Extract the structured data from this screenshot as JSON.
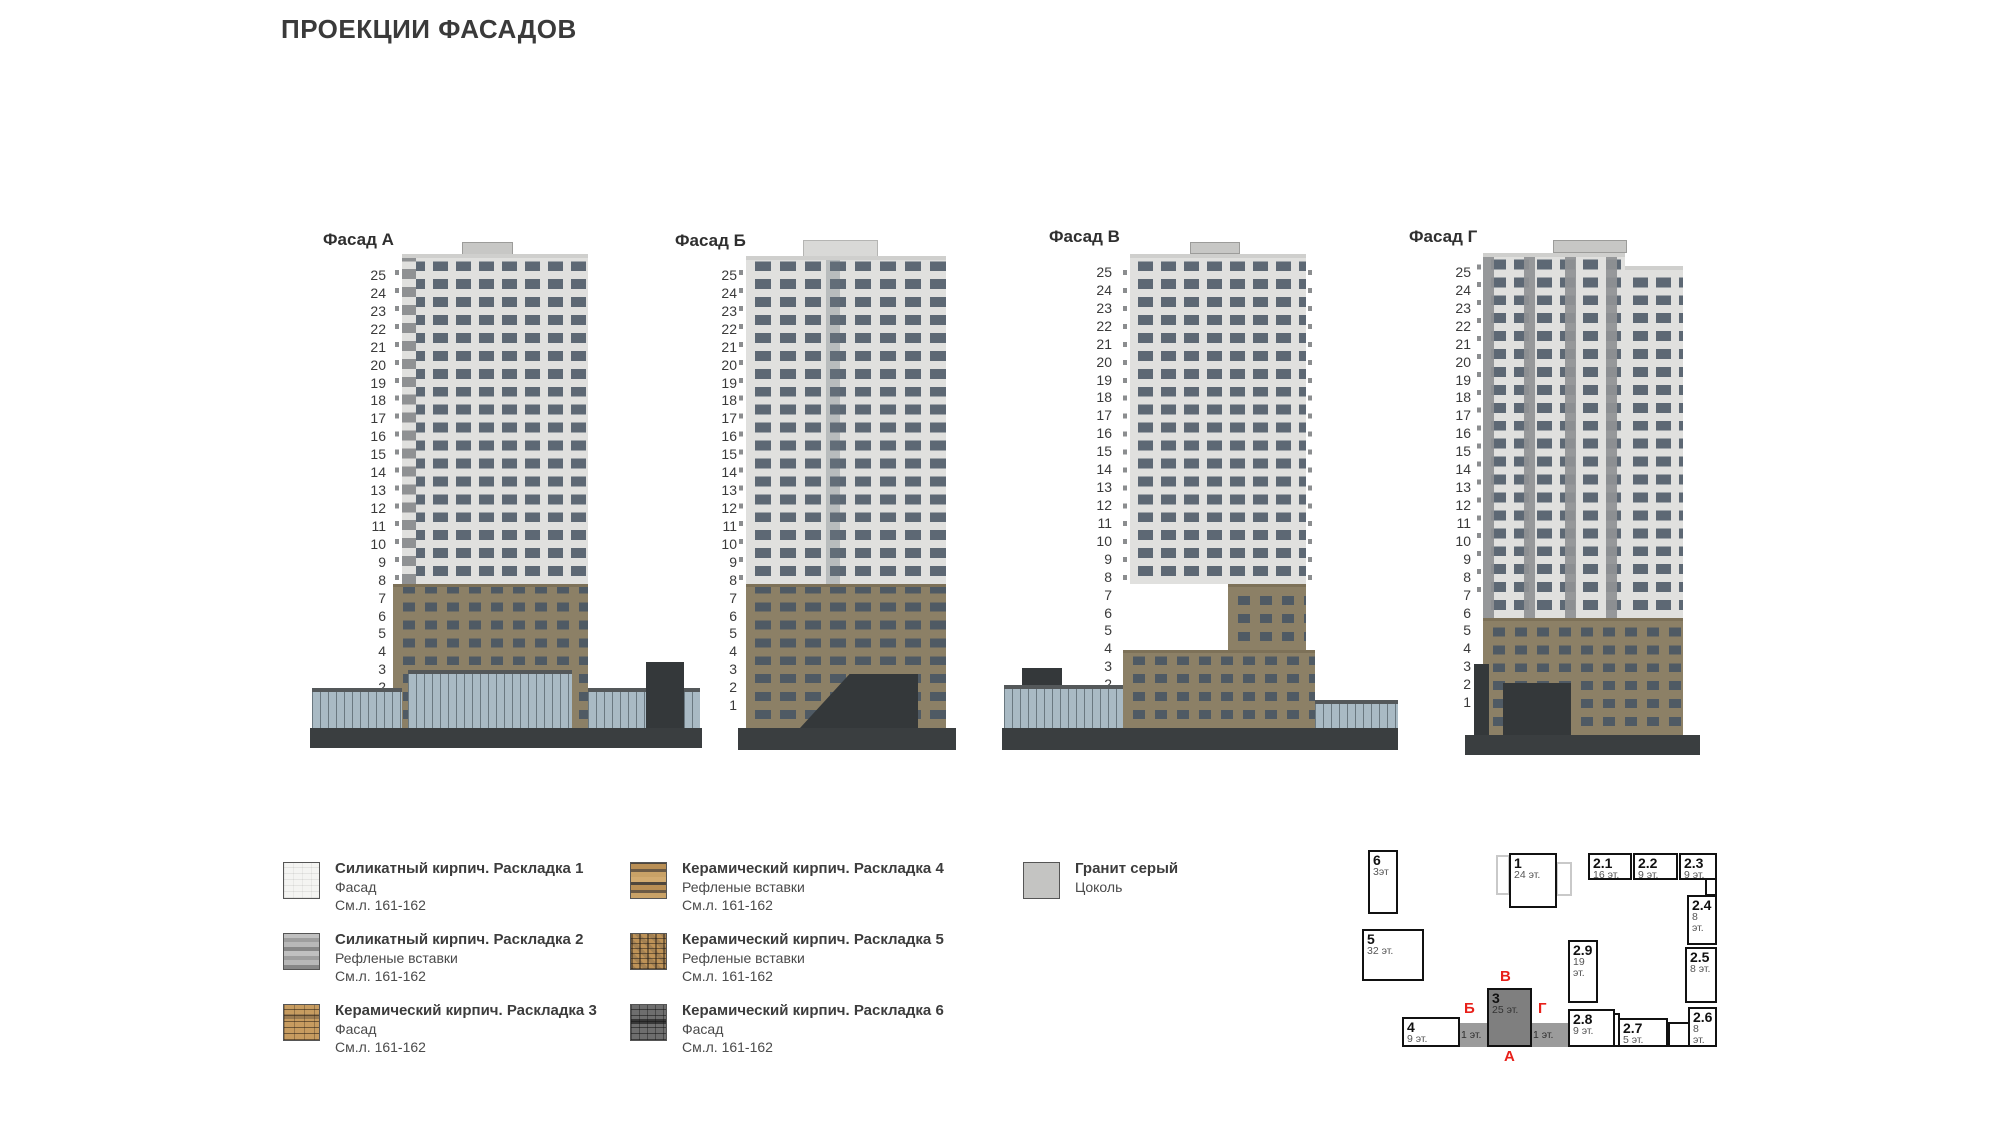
{
  "title": "ПРОЕКЦИИ ФАСАДОВ",
  "floor_numbers": [
    25,
    24,
    23,
    22,
    21,
    20,
    19,
    18,
    17,
    16,
    15,
    14,
    13,
    12,
    11,
    10,
    9,
    8,
    7,
    6,
    5,
    4,
    3,
    2,
    1
  ],
  "facades": [
    {
      "id": "a",
      "label": "Фасад А"
    },
    {
      "id": "b",
      "label": "Фасад Б"
    },
    {
      "id": "v",
      "label": "Фасад В"
    },
    {
      "id": "g",
      "label": "Фасад Г"
    }
  ],
  "legend": {
    "items": [
      {
        "title": "Силикатный кирпич. Раскладка 1",
        "line2": "Фасад",
        "line3": "См.л. 161-162",
        "swatch": "s1"
      },
      {
        "title": "Силикатный кирпич. Раскладка 2",
        "line2": "Рефленые вставки",
        "line3": "См.л. 161-162",
        "swatch": "s2"
      },
      {
        "title": "Керамический кирпич. Раскладка 3",
        "line2": "Фасад",
        "line3": "См.л. 161-162",
        "swatch": "s3"
      },
      {
        "title": "Керамический кирпич. Раскладка 4",
        "line2": "Рефленые вставки",
        "line3": "См.л. 161-162",
        "swatch": "s4"
      },
      {
        "title": "Керамический кирпич. Раскладка 5",
        "line2": "Рефленые вставки",
        "line3": "См.л. 161-162",
        "swatch": "s5"
      },
      {
        "title": "Керамический кирпич. Раскладка 6",
        "line2": "Фасад",
        "line3": "См.л. 161-162",
        "swatch": "s6"
      },
      {
        "title": "Гранит серый",
        "line2": "Цоколь",
        "line3": "",
        "swatch": "s7"
      }
    ]
  },
  "site_plan": {
    "blocks": [
      {
        "id": "6",
        "num": "6",
        "floors": "3эт"
      },
      {
        "id": "5",
        "num": "5",
        "floors": "32 эт."
      },
      {
        "id": "1",
        "num": "1",
        "floors": "24 эт."
      },
      {
        "id": "2.1",
        "num": "2.1",
        "floors": "16 эт."
      },
      {
        "id": "2.2",
        "num": "2.2",
        "floors": "9 эт."
      },
      {
        "id": "2.3",
        "num": "2.3",
        "floors": "9 эт."
      },
      {
        "id": "2.4",
        "num": "2.4",
        "floors": "8 эт."
      },
      {
        "id": "2.5",
        "num": "2.5",
        "floors": "8 эт."
      },
      {
        "id": "2.6",
        "num": "2.6",
        "floors": "8 эт."
      },
      {
        "id": "2.9",
        "num": "2.9",
        "floors": "19 эт."
      },
      {
        "id": "2.8",
        "num": "2.8",
        "floors": "9 эт."
      },
      {
        "id": "2.7",
        "num": "2.7",
        "floors": "5 эт."
      },
      {
        "id": "3",
        "num": "3",
        "floors": "25 эт.",
        "highlight": true
      },
      {
        "id": "4",
        "num": "4",
        "floors": "9 эт."
      }
    ],
    "connectors": [
      {
        "label": "1 эт."
      },
      {
        "label": "1 эт."
      }
    ],
    "markers": [
      "В",
      "Б",
      "Г",
      "А"
    ]
  },
  "colors": {
    "red_marker": "#e8201a",
    "wall_light": "#e0e0de",
    "window": "#5d6874",
    "brick": "#8c8066",
    "dark_elements": "#34383a",
    "glass": "#a9bac4",
    "panel_gray": "#909294",
    "site_block_highlight": "#7f7f7f"
  }
}
